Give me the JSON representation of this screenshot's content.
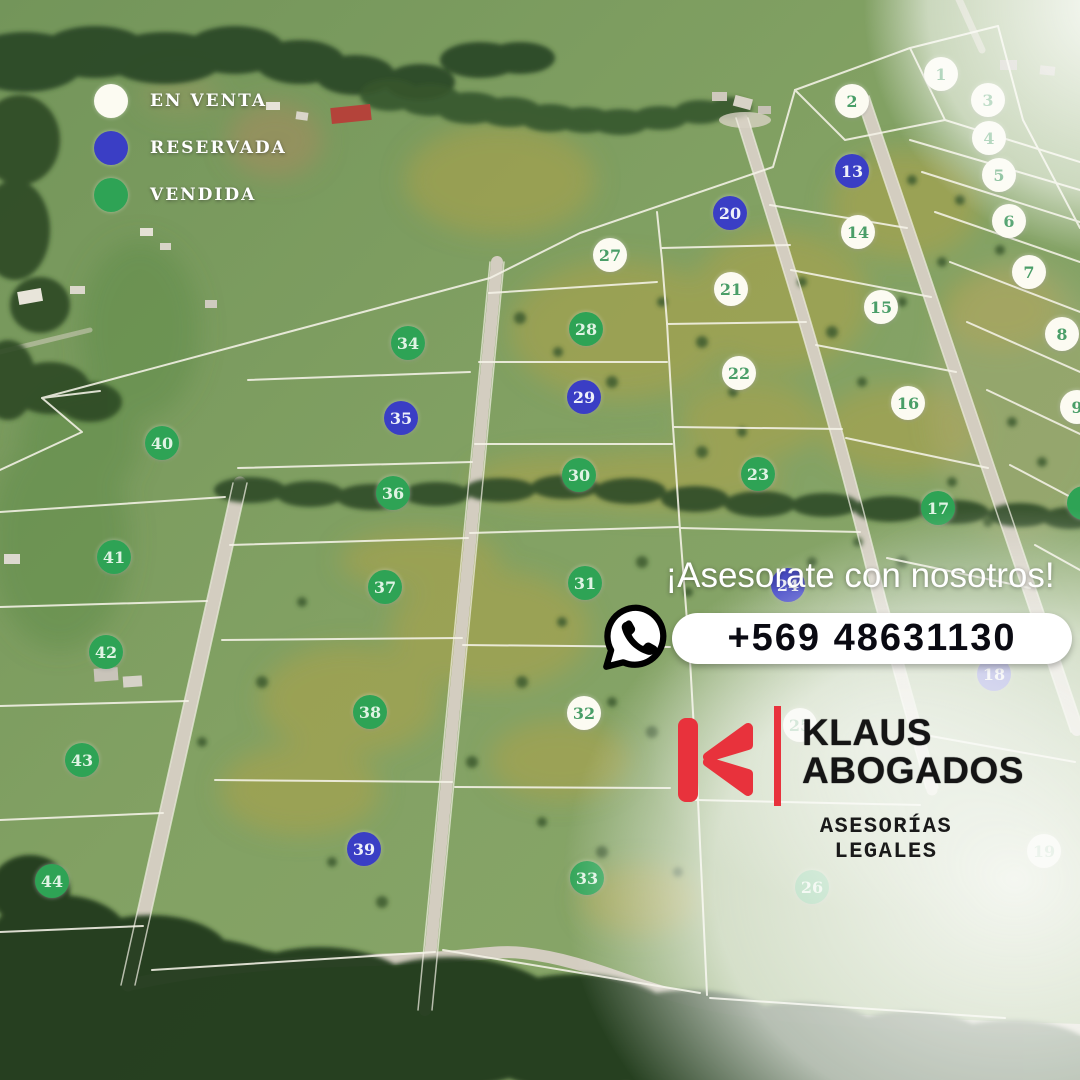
{
  "legend": {
    "items": [
      {
        "label": "EN VENTA",
        "status": "en_venta"
      },
      {
        "label": "RESERVADA",
        "status": "reservada"
      },
      {
        "label": "VENDIDA",
        "status": "vendida"
      }
    ]
  },
  "status_colors": {
    "en_venta": "#fcfbf2",
    "reservada": "#3a3ec5",
    "vendida": "#2ea355"
  },
  "contact": {
    "message": "¡Asesorate con nosotros!",
    "phone": "+569 48631130",
    "icon": "whatsapp-icon"
  },
  "brand": {
    "name_line1": "KLAUS",
    "name_line2": "ABOGADOS",
    "tagline": "ASESORÍAS LEGALES",
    "accent_color": "#e8323c"
  },
  "plots": [
    {
      "number": "1",
      "status": "en_venta",
      "x": 941,
      "y": 74
    },
    {
      "number": "2",
      "status": "en_venta",
      "x": 852,
      "y": 101
    },
    {
      "number": "3",
      "status": "en_venta",
      "x": 988,
      "y": 100
    },
    {
      "number": "4",
      "status": "en_venta",
      "x": 989,
      "y": 138
    },
    {
      "number": "5",
      "status": "en_venta",
      "x": 999,
      "y": 175
    },
    {
      "number": "6",
      "status": "en_venta",
      "x": 1009,
      "y": 221
    },
    {
      "number": "7",
      "status": "en_venta",
      "x": 1029,
      "y": 272
    },
    {
      "number": "8",
      "status": "en_venta",
      "x": 1062,
      "y": 334
    },
    {
      "number": "9",
      "status": "en_venta",
      "x": 1077,
      "y": 407
    },
    {
      "number": "13",
      "status": "reservada",
      "x": 852,
      "y": 171
    },
    {
      "number": "14",
      "status": "en_venta",
      "x": 858,
      "y": 232
    },
    {
      "number": "15",
      "status": "en_venta",
      "x": 881,
      "y": 307
    },
    {
      "number": "16",
      "status": "en_venta",
      "x": 908,
      "y": 403
    },
    {
      "number": "17",
      "status": "vendida",
      "x": 938,
      "y": 508
    },
    {
      "number": "18",
      "status": "reservada",
      "x": 994,
      "y": 674
    },
    {
      "number": "19",
      "status": "en_venta",
      "x": 1044,
      "y": 851
    },
    {
      "number": "20",
      "status": "reservada",
      "x": 730,
      "y": 213
    },
    {
      "number": "21",
      "status": "en_venta",
      "x": 731,
      "y": 289
    },
    {
      "number": "22",
      "status": "en_venta",
      "x": 739,
      "y": 373
    },
    {
      "number": "23",
      "status": "vendida",
      "x": 758,
      "y": 474
    },
    {
      "number": "24",
      "status": "reservada",
      "x": 788,
      "y": 585
    },
    {
      "number": "25",
      "status": "en_venta",
      "x": 800,
      "y": 725
    },
    {
      "number": "26",
      "status": "vendida",
      "x": 812,
      "y": 887
    },
    {
      "number": "27",
      "status": "en_venta",
      "x": 610,
      "y": 255
    },
    {
      "number": "28",
      "status": "vendida",
      "x": 586,
      "y": 329
    },
    {
      "number": "29",
      "status": "reservada",
      "x": 584,
      "y": 397
    },
    {
      "number": "30",
      "status": "vendida",
      "x": 579,
      "y": 475
    },
    {
      "number": "31",
      "status": "vendida",
      "x": 585,
      "y": 583
    },
    {
      "number": "32",
      "status": "en_venta",
      "x": 584,
      "y": 713
    },
    {
      "number": "33",
      "status": "vendida",
      "x": 587,
      "y": 878
    },
    {
      "number": "34",
      "status": "vendida",
      "x": 408,
      "y": 343
    },
    {
      "number": "35",
      "status": "reservada",
      "x": 401,
      "y": 418
    },
    {
      "number": "36",
      "status": "vendida",
      "x": 393,
      "y": 493
    },
    {
      "number": "37",
      "status": "vendida",
      "x": 385,
      "y": 587
    },
    {
      "number": "38",
      "status": "vendida",
      "x": 370,
      "y": 712
    },
    {
      "number": "39",
      "status": "reservada",
      "x": 364,
      "y": 849
    },
    {
      "number": "40",
      "status": "vendida",
      "x": 162,
      "y": 443
    },
    {
      "number": "41",
      "status": "vendida",
      "x": 114,
      "y": 557
    },
    {
      "number": "42",
      "status": "vendida",
      "x": 106,
      "y": 652
    },
    {
      "number": "43",
      "status": "vendida",
      "x": 82,
      "y": 760
    },
    {
      "number": "44",
      "status": "vendida",
      "x": 52,
      "y": 881
    },
    {
      "number": "",
      "status": "vendida",
      "x": 1084,
      "y": 503
    }
  ]
}
